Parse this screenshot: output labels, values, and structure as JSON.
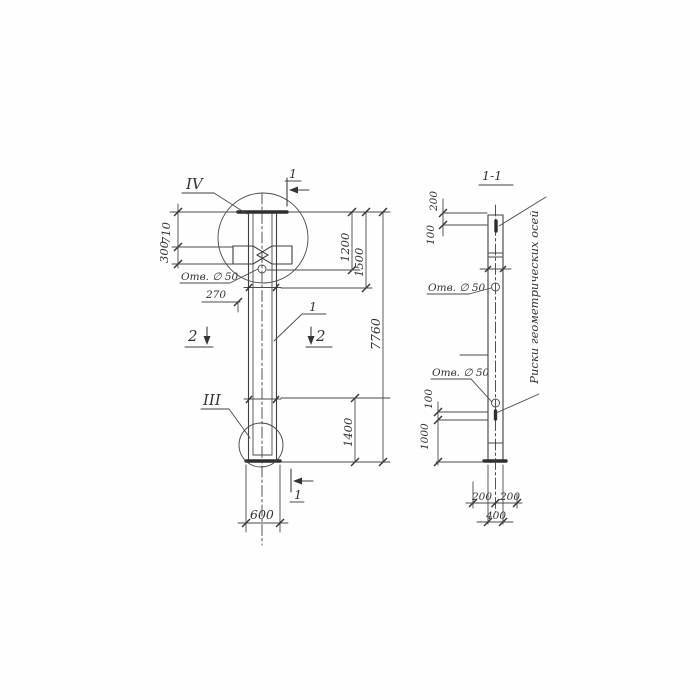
{
  "drawing": {
    "background": "#fefefe",
    "line_color": "#3f3f3f",
    "views": {
      "front": {
        "detail_marker_top": "IV",
        "detail_marker_bottom": "III",
        "section_cut_top": "1",
        "section_cut_bottom": "1",
        "section_cut_left": "2",
        "section_cut_right": "2",
        "part_leader": "1",
        "hole_label": "Отв. ∅ 50",
        "dims": {
          "cap_to_flange": "710",
          "flange_height": "300",
          "hole_offset": "270",
          "top_to_hole": "1200",
          "top_to_mark": "1500",
          "total_height": "7760",
          "bottom_segment": "1400",
          "width": "600"
        }
      },
      "section": {
        "title": "1-1",
        "hole_label_upper": "Отв. ∅ 50",
        "hole_label_lower": "Отв. ∅ 50",
        "axes_note": "Риски геометрических осей",
        "dims": {
          "top_to_mark": "200",
          "mark_depth": "100",
          "hole_to_mark": "100",
          "mark_to_bottom": "1000",
          "half_width_left": "200",
          "half_width_right": "200",
          "width": "400"
        }
      }
    }
  }
}
